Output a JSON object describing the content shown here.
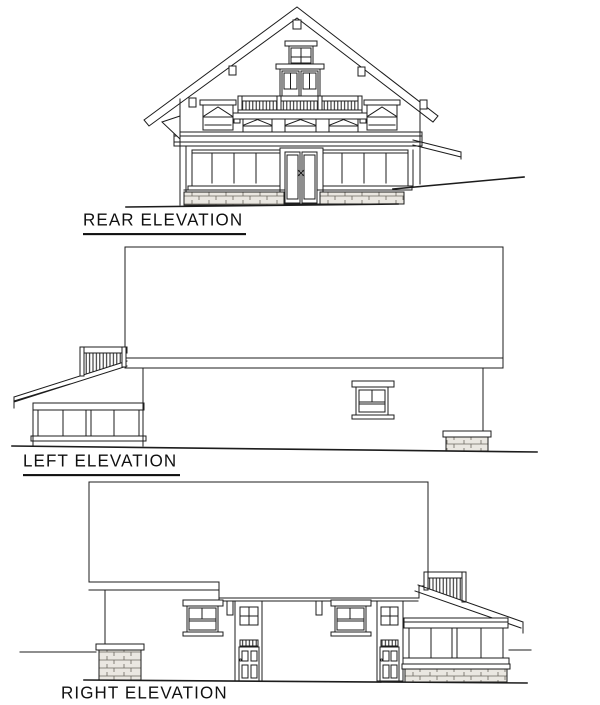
{
  "sheet": {
    "background_color": "#ffffff",
    "ink_color": "#1c1c1c",
    "stone_fill_color": "#eae7e1",
    "elevations": [
      {
        "id": "rear",
        "label": "REAR ELEVATION"
      },
      {
        "id": "left",
        "label": "LEFT ELEVATION"
      },
      {
        "id": "right",
        "label": "RIGHT ELEVATION"
      }
    ]
  }
}
